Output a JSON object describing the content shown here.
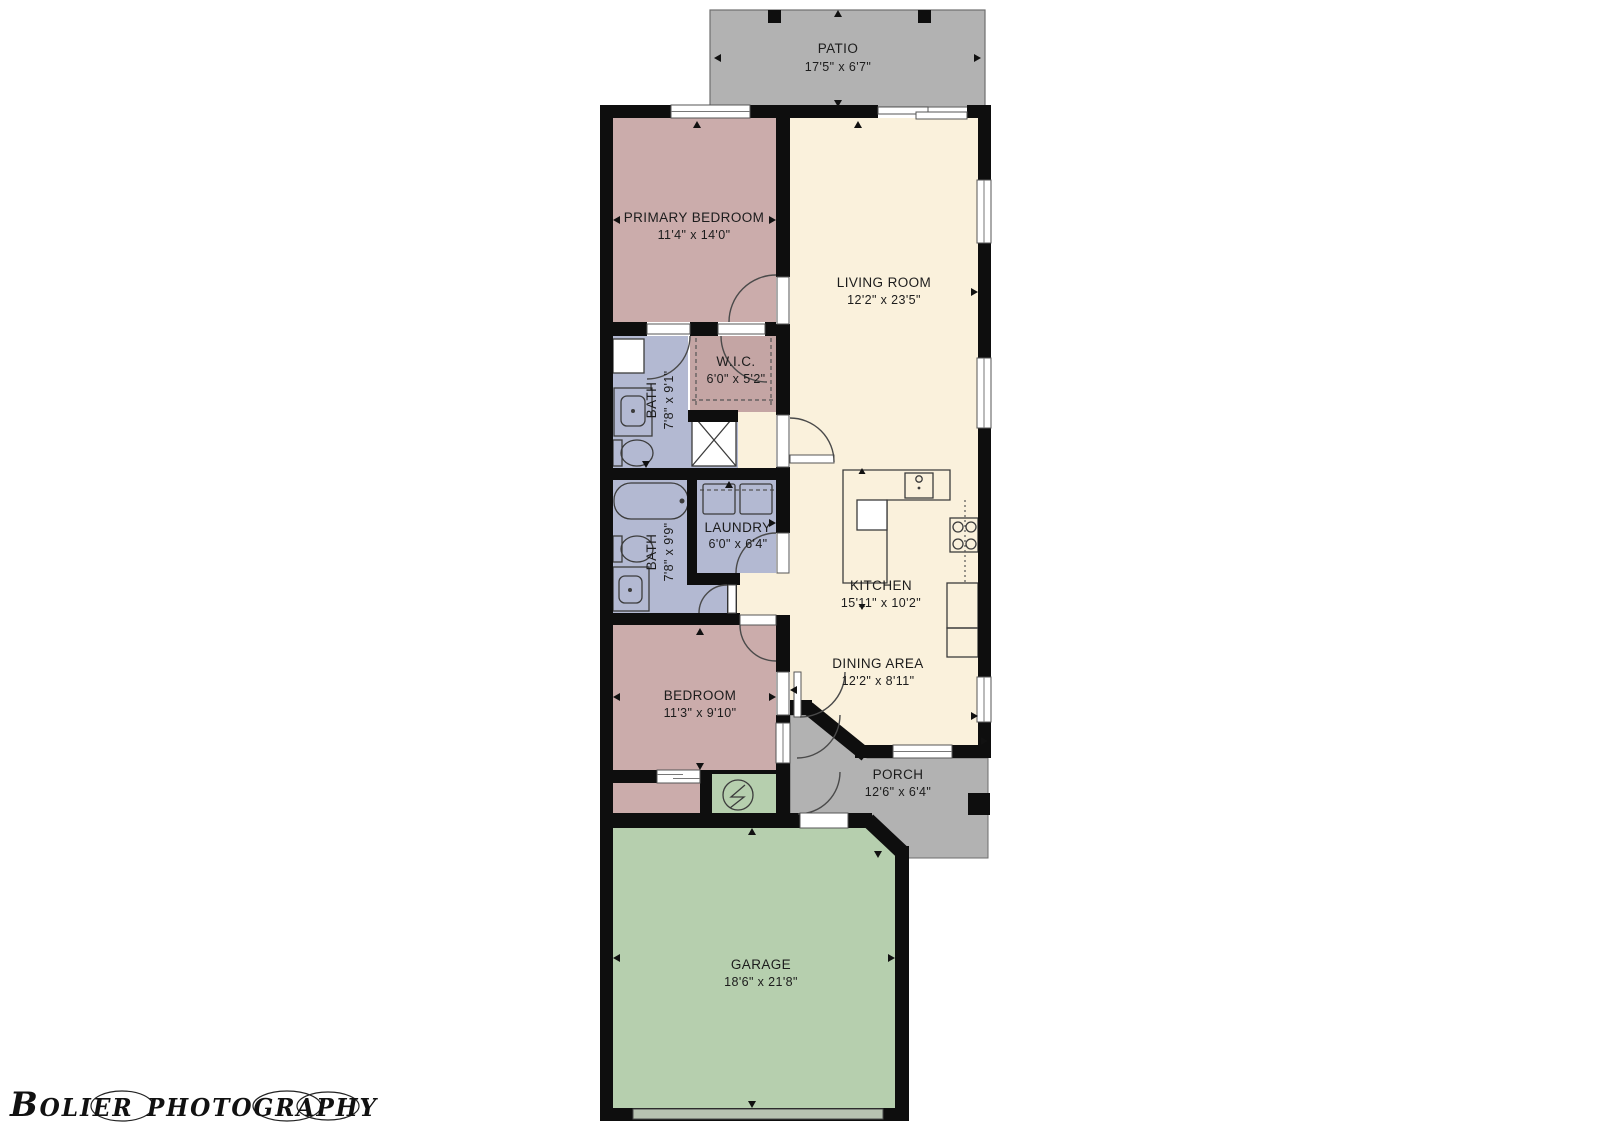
{
  "watermark": {
    "text": "Bolier photography"
  },
  "palette": {
    "wall": "#0e0e0e",
    "living_cream": "#faf1dc",
    "bedroom_mauve": "#cbacab",
    "bath_lavender": "#b3b9d2",
    "garage_green": "#b6cfae",
    "patio_gray": "#b2b2b2",
    "garage_door_band": "#b7c2b1"
  },
  "rooms": {
    "patio": {
      "name": "PATIO",
      "dims": "17'5\" x 6'7\""
    },
    "primary_bedroom": {
      "name": "PRIMARY BEDROOM",
      "dims": "11'4\" x 14'0\""
    },
    "living_room": {
      "name": "LIVING ROOM",
      "dims": "12'2\" x 23'5\""
    },
    "wic": {
      "name": "W.I.C.",
      "dims": "6'0\" x 5'2\""
    },
    "bath1": {
      "name": "BATH",
      "dims": "7'8\" x 9'1\""
    },
    "bath2": {
      "name": "BATH",
      "dims": "7'8\" x 9'9\""
    },
    "laundry": {
      "name": "LAUNDRY",
      "dims": "6'0\" x 6'4\""
    },
    "kitchen": {
      "name": "KITCHEN",
      "dims": "15'11\" x 10'2\""
    },
    "dining": {
      "name": "DINING AREA",
      "dims": "12'2\" x 8'11\""
    },
    "bedroom": {
      "name": "BEDROOM",
      "dims": "11'3\" x 9'10\""
    },
    "porch": {
      "name": "PORCH",
      "dims": "12'6\" x 6'4\""
    },
    "garage": {
      "name": "GARAGE",
      "dims": "18'6\" x 21'8\""
    }
  }
}
